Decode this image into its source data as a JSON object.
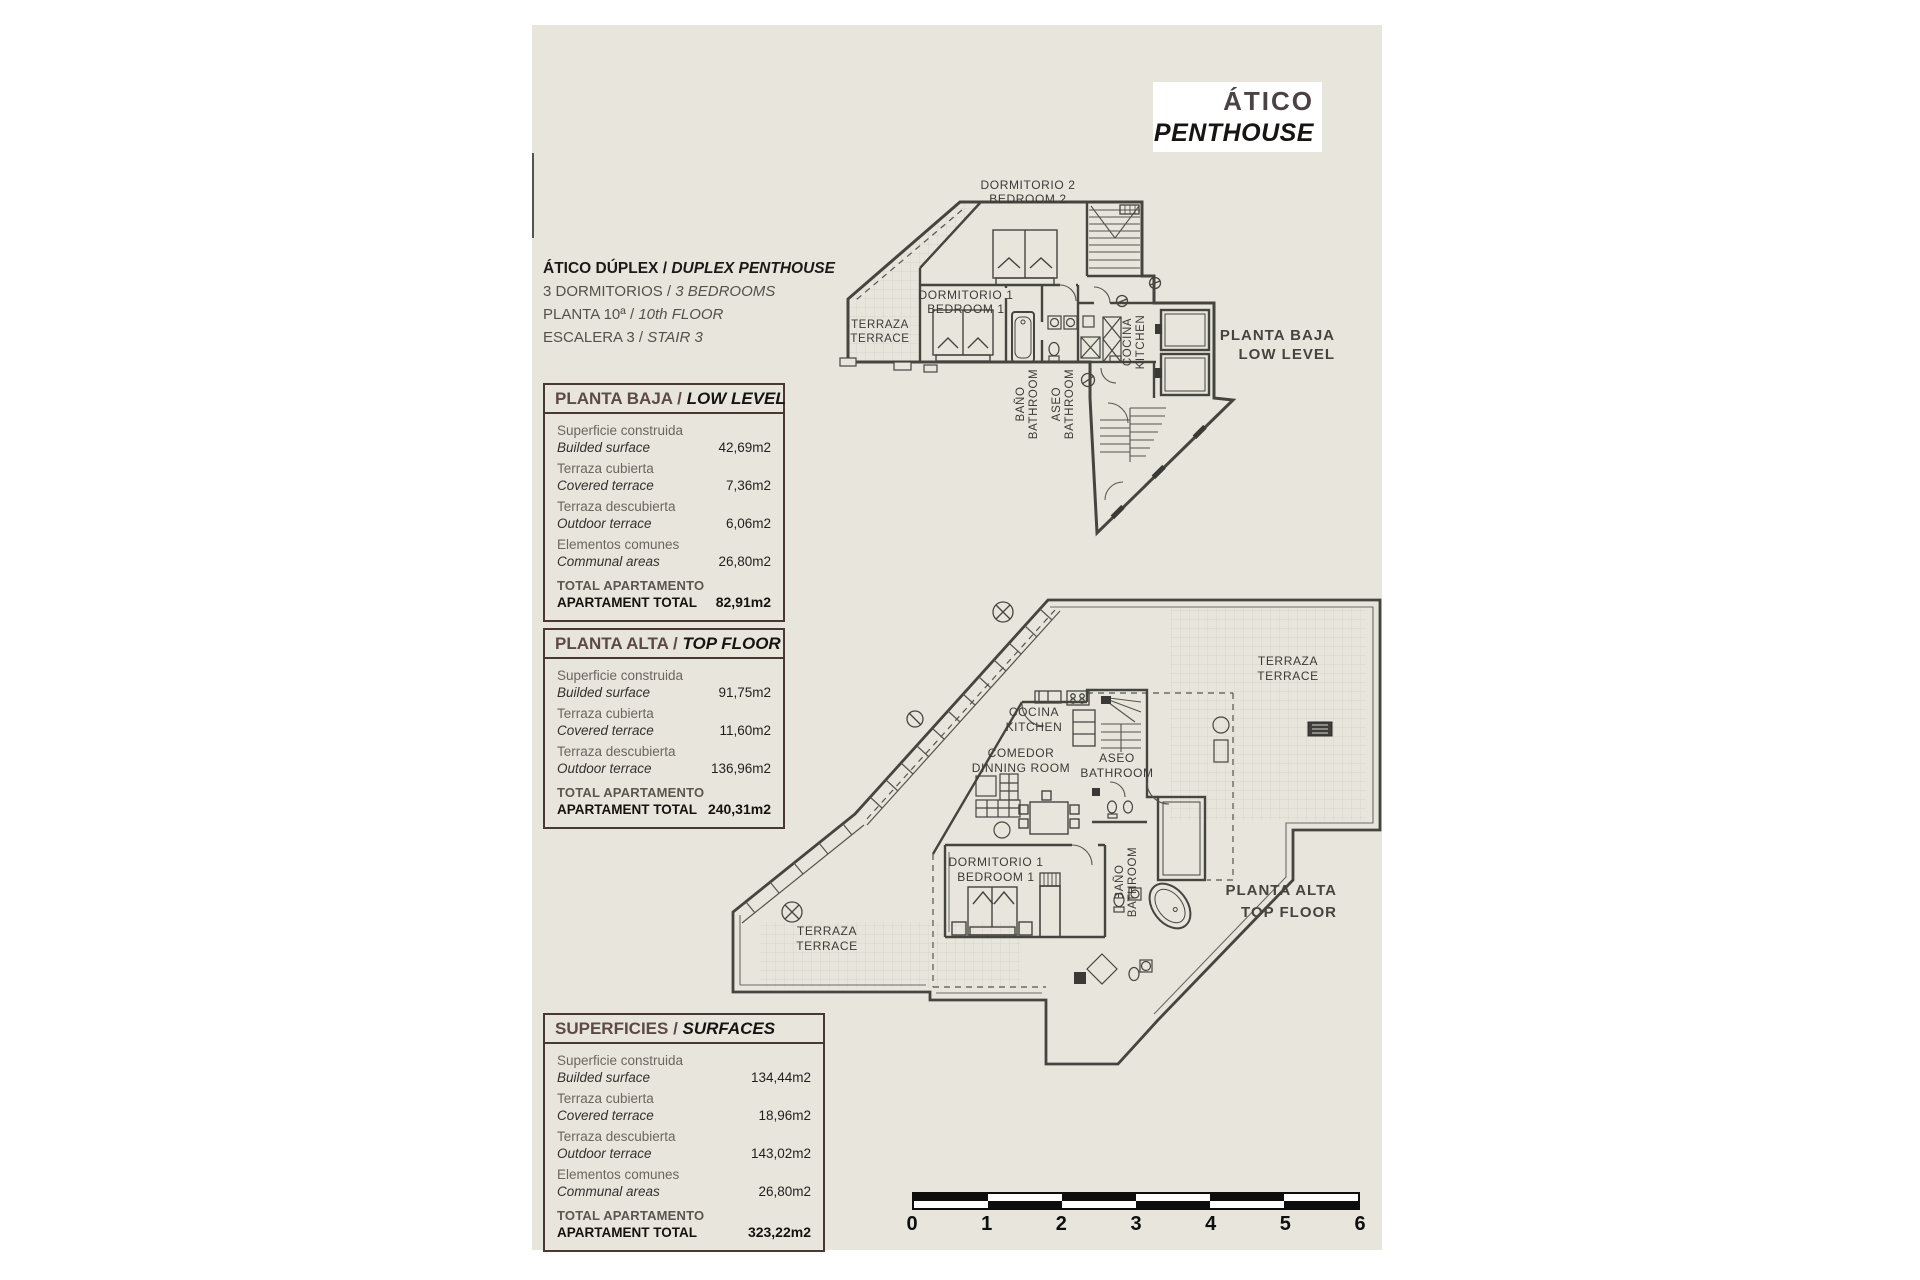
{
  "colors": {
    "paper": "#e8e6dc",
    "accent": "#4a3835",
    "ink": "#45443f"
  },
  "title_box": {
    "es": "ÁTICO",
    "en": "PENTHOUSE"
  },
  "description": {
    "lines": [
      {
        "es": "ÁTICO DÚPLEX / ",
        "en": "DUPLEX PENTHOUSE"
      },
      {
        "es": "3 DORMITORIOS / ",
        "en": "3 BEDROOMS"
      },
      {
        "es": "PLANTA 10ª / ",
        "en": "10th FLOOR"
      },
      {
        "es": "ESCALERA 3 / ",
        "en": "STAIR 3"
      }
    ]
  },
  "boxes": {
    "low": {
      "title_es": "PLANTA BAJA / ",
      "title_en": "LOW LEVEL",
      "rows": [
        {
          "es": "Superficie construida",
          "en": "Builded surface",
          "value": "42,69m2"
        },
        {
          "es": "Terraza cubierta",
          "en": "Covered terrace",
          "value": "7,36m2"
        },
        {
          "es": "Terraza descubierta",
          "en": "Outdoor terrace",
          "value": "6,06m2"
        },
        {
          "es": "Elementos comunes",
          "en": "Communal areas",
          "value": "26,80m2"
        }
      ],
      "total_es": "TOTAL APARTAMENTO",
      "total_en": "APARTAMENT TOTAL",
      "total_value": "82,91m2"
    },
    "top": {
      "title_es": "PLANTA ALTA / ",
      "title_en": "TOP FLOOR",
      "rows": [
        {
          "es": "Superficie construida",
          "en": "Builded surface",
          "value": "91,75m2"
        },
        {
          "es": "Terraza cubierta",
          "en": "Covered terrace",
          "value": "11,60m2"
        },
        {
          "es": "Terraza descubierta",
          "en": "Outdoor terrace",
          "value": "136,96m2"
        }
      ],
      "total_es": "TOTAL APARTAMENTO",
      "total_en": "APARTAMENT TOTAL",
      "total_value": "240,31m2"
    },
    "surfaces": {
      "title_es": "SUPERFICIES / ",
      "title_en": "SURFACES",
      "rows": [
        {
          "es": "Superficie construida",
          "en": "Builded surface",
          "value": "134,44m2"
        },
        {
          "es": "Terraza cubierta",
          "en": "Covered terrace",
          "value": "18,96m2"
        },
        {
          "es": "Terraza descubierta",
          "en": "Outdoor terrace",
          "value": "143,02m2"
        },
        {
          "es": "Elementos comunes",
          "en": "Communal areas",
          "value": "26,80m2"
        }
      ],
      "total_es": "TOTAL APARTAMENTO",
      "total_en": "APARTAMENT TOTAL",
      "total_value": "323,22m2"
    }
  },
  "plans": {
    "low": {
      "bedroom2_l1": "DORMITORIO 2",
      "bedroom2_l2": "BEDROOM 2",
      "terrace_l1": "TERRAZA",
      "terrace_l2": "TERRACE",
      "bedroom1_l1": "DORMITORIO 1",
      "bedroom1_l2": "BEDROOM 1",
      "bath_l1": "BAÑO",
      "bath_l2": "BATHROOM",
      "aseo_l1": "ASEO",
      "aseo_l2": "BATHROOM",
      "kitchen_l1": "COCINA",
      "kitchen_l2": "KITCHEN",
      "side_l1": "PLANTA BAJA",
      "side_l2": "LOW LEVEL"
    },
    "top": {
      "terrace_top_l1": "TERRAZA",
      "terrace_top_l2": "TERRACE",
      "kitchen_l1": "COCINA",
      "kitchen_l2": "KITCHEN",
      "dining_l1": "COMEDOR",
      "dining_l2": "DINNING ROOM",
      "aseo_l1": "ASEO",
      "aseo_l2": "BATHROOM",
      "bedroom1_l1": "DORMITORIO 1",
      "bedroom1_l2": "BEDROOM 1",
      "bath_l1": "BAÑO",
      "bath_l2": "BATHROOM",
      "terrace_bottom_l1": "TERRAZA",
      "terrace_bottom_l2": "TERRACE",
      "side_l1": "PLANTA ALTA",
      "side_l2": "TOP FLOOR"
    }
  },
  "scalebar": {
    "ticks": [
      "0",
      "1",
      "2",
      "3",
      "4",
      "5",
      "6"
    ]
  }
}
